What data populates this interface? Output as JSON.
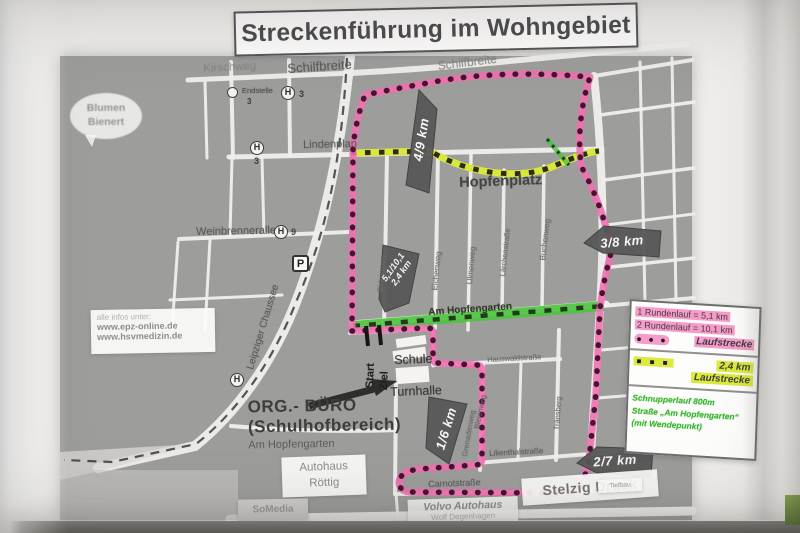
{
  "title": "Streckenführung im Wohngebiet",
  "colors": {
    "paper": "#f0eeeb",
    "map_gray": "#9d9d9c",
    "street_white": "#efeeec",
    "route_pink": "#f170b2",
    "route_dot": "#44152c",
    "route_yellowgreen": "#d9e73b",
    "route_green": "#4cc43e",
    "sign_gray": "#585858",
    "legend_pink": "#f79bcb",
    "legend_yellowgreen": "#dcea3e",
    "legend_green_text": "#35b42c"
  },
  "info_box": {
    "line1": "alle infos unter:",
    "line2": "www.epz-online.de",
    "line3": "www.hsvmedizin.de"
  },
  "bubble": {
    "line1": "Blumen",
    "line2": "Bienert"
  },
  "streets": {
    "kirschweg": "Kirschweg",
    "schilfbreite1": "Schilfbreite",
    "schilfbreite2": "Schilfbreite",
    "lindenplan": "Lindenplan",
    "hopfenplatz": "Hopfenplatz",
    "weinbrennerallee": "Weinbrennerallee",
    "leipziger_chaussee": "Leipziger Chaussee",
    "am_hopfengarten": "Am Hopfengarten",
    "birkenweg": "Birkenweg",
    "eichenweg": "Eichenweg",
    "ulmenweg": "Ulmenweg",
    "laerchenstrasse": "Lärchenstraße",
    "buchenweg": "Buchenweg",
    "hauswaldstrasse": "Hauswaldstraße",
    "grenadierweg": "Grenadierweg",
    "bleienweg": "Bleienweg",
    "traensberg": "Tränsberg",
    "lilienthalstrasse": "Lilienthalstraße",
    "carnotstrasse": "Carnotstraße"
  },
  "transit": {
    "h": "H",
    "endstelle": "Endstelle",
    "endstelle_line": "3",
    "stop_top_line": "3",
    "stop_lindenplan_line": "3",
    "stop_weinbrenner_line": "9",
    "parking": "P"
  },
  "start_finish": {
    "start": "Start",
    "ziel": "Ziel"
  },
  "buildings": {
    "schule": "Schule",
    "turnhalle": "Turnhalle"
  },
  "org_buero": {
    "line1": "ORG.- BÜRO",
    "line2": "(Schulhofbereich)",
    "line3": "Am Hopfengarten"
  },
  "km_markers": {
    "m1": "4/9 km",
    "m2": "3/8 km",
    "m3a": "5,1/10,1",
    "m3b": "2,4 km",
    "m4": "1/6 km",
    "m5": "2/7 km"
  },
  "businesses": {
    "autohaus1": "Autohaus",
    "autohaus2": "Röttig",
    "somedia": "SoMedia",
    "volvo1": "Volvo Autohaus",
    "volvo2": "Wolf Degenhagen",
    "stelzig": "Stelzig Druck",
    "tiefbau": "Tiefbau"
  },
  "legend": {
    "row1": "1 Rundenlauf = 5,1 km",
    "row2": "2 Rundenlauf = 10,1 km",
    "dots": "● ● ●",
    "laufstrecke1": "Laufstrecke",
    "squares": "■ ■ ■",
    "km24": "2,4 km",
    "laufstrecke2": "Laufstrecke",
    "green1": "Schnupperlauf 800m",
    "green2": "Straße „Am Hopfengarten“",
    "green3": "(mit Wendepunkt)"
  }
}
